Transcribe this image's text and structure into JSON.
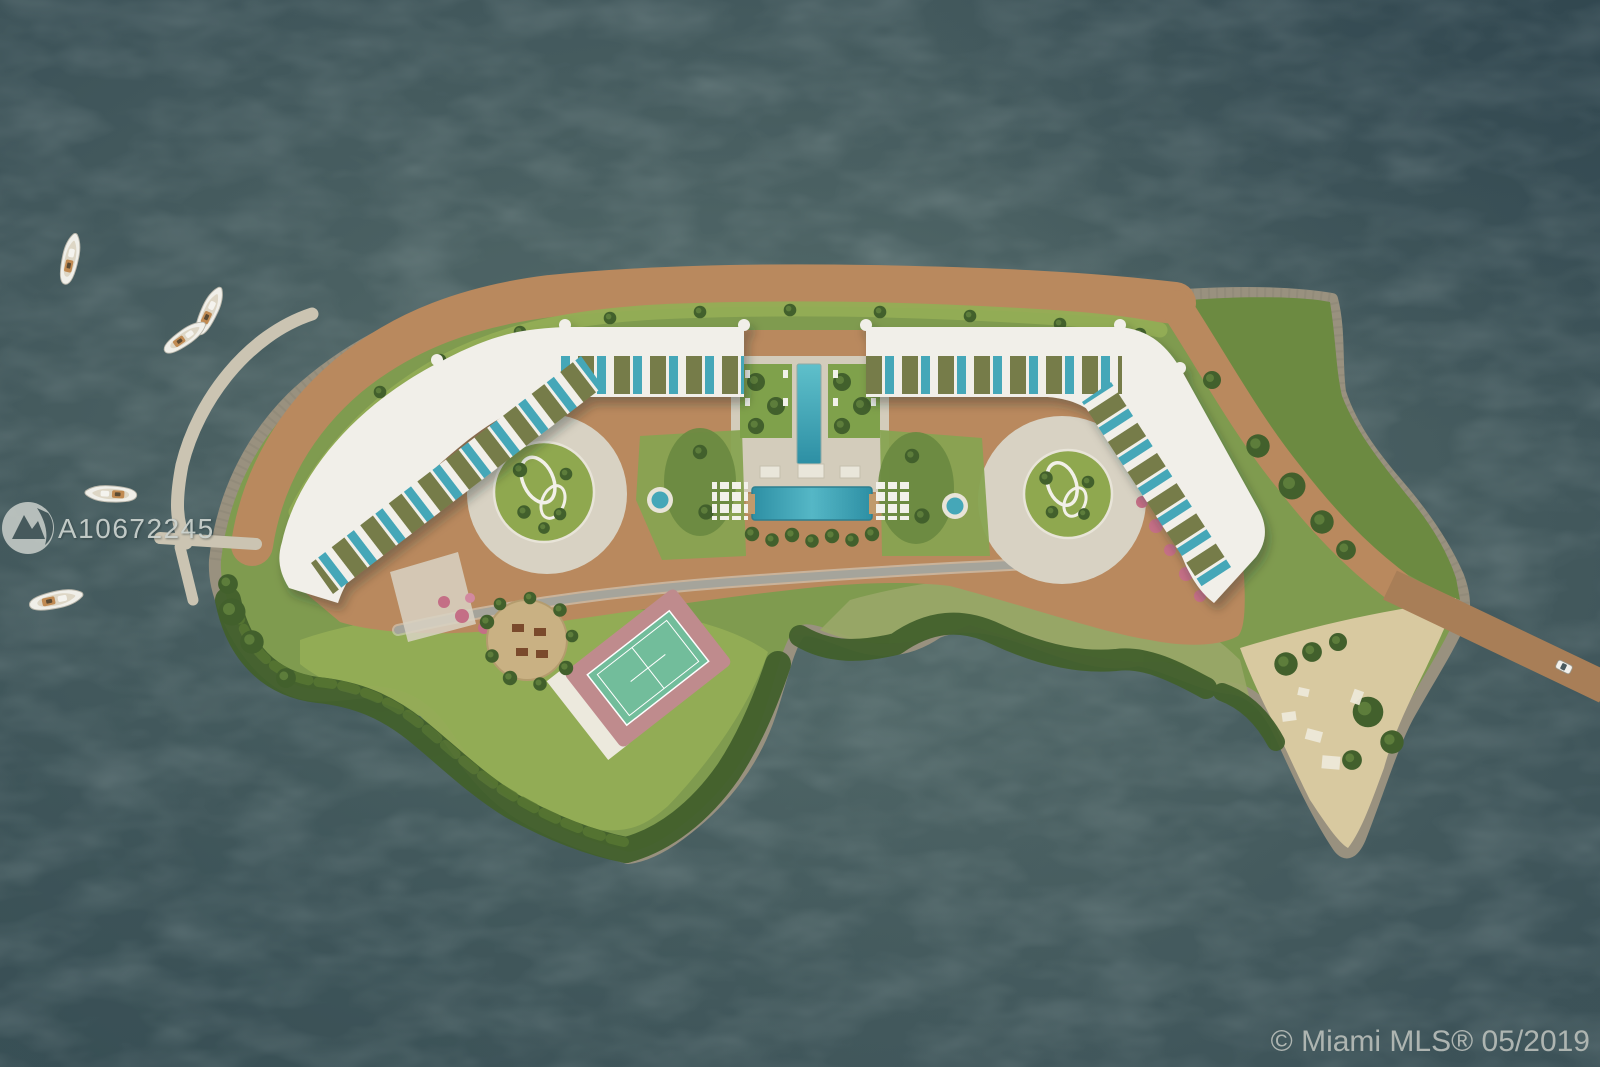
{
  "image": {
    "type": "aerial-rendering",
    "subject": "Top-down site plan rendering of a private island residential development surrounded by bay water, with two curved white condo wings, rooftop plunge pools, central lap pools, tennis court, circular gardens, marina dock with boats, sandy beach point and access bridge with a car"
  },
  "watermark": {
    "listing_id": "A10672245",
    "logo": "miami-mls-logo"
  },
  "footer": {
    "copyright": "© Miami MLS® 05/2019"
  },
  "palette": {
    "water_base": "#42585c",
    "water_glow": "#5b7270",
    "water_dark": "#334a52",
    "rock_edge": "#99917f",
    "path_brown": "#b9895e",
    "bridge_brown": "#a87e57",
    "grass_base": "#7f9b4f",
    "grass_bright": "#94ad55",
    "scrub_green": "#6c8a41",
    "tree_dark": "#42602c",
    "meadow_pale": "#9aa768",
    "sand_beach": "#d8c9a0",
    "building_white": "#f1efe9",
    "deck_olive": "#767c49",
    "pool_teal": "#45a7b8",
    "paver": "#d8d2c3",
    "road_gray": "#a5a49b",
    "court_green": "#72bd9b",
    "court_apron": "#bf8b8d",
    "flower_pink": "#c46f86",
    "wood_deck": "#c9b183",
    "watermark_gray": "#ccd3cf",
    "copyright_gray": "#b4bab6"
  },
  "scene_features": [
    "bay-water",
    "island",
    "north-shore-path",
    "rocky-revetment",
    "left-condo-wing",
    "right-condo-wing",
    "rooftop-decks-with-plunge-pools",
    "central-lap-pool",
    "main-pool-with-cabanas",
    "palm-gardens",
    "left-circular-courtyard",
    "right-circular-courtyard",
    "tennis-court",
    "picnic-deck-circle",
    "south-meadow",
    "mangrove-tree-fringe",
    "sandy-beach-point",
    "beach-loungers",
    "access-bridge",
    "car-on-bridge",
    "curved-marina-dock",
    "boats",
    "road"
  ]
}
